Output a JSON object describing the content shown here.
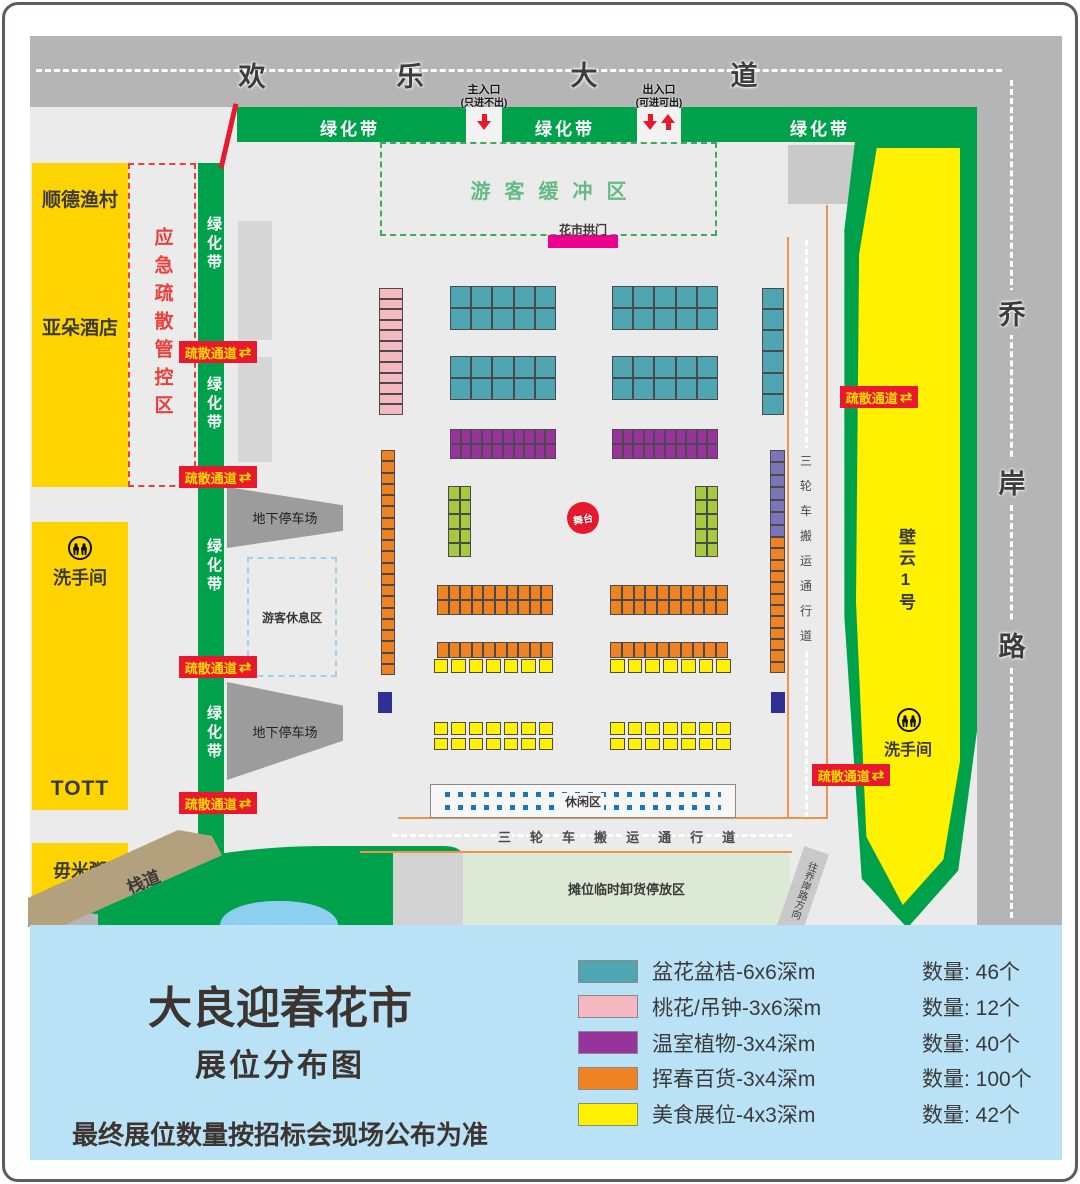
{
  "palette": {
    "road": "#b5b5b5",
    "ground": "#ebebeb",
    "green": "#00a14b",
    "buildingYellow": "#ffd400",
    "brightYellow": "#fff100",
    "teal": "#4fa6b2",
    "pink": "#f4b8c1",
    "purple": "#97339b",
    "orange": "#ef8222",
    "lime": "#a6c93f",
    "slate": "#7b74b9",
    "navy": "#2e3192",
    "magenta": "#ec008c",
    "red": "#e8192c",
    "brown": "#b3a17e",
    "paleGreen": "#dcead5",
    "legendBlue": "#b9e2f6",
    "pond": "#8ccfee",
    "grayBuilding": "#d6d6d6",
    "parkingGray": "#9c9c9c"
  },
  "roads": {
    "top_name": "欢乐大道",
    "right_name": "乔岸路"
  },
  "entrances": {
    "main": {
      "title": "主入口",
      "note": "(只进不出)"
    },
    "exit": {
      "title": "出入口",
      "note": "(可进可出)"
    }
  },
  "belts": {
    "label": "绿化带"
  },
  "badges": {
    "label": "疏散通道",
    "arrow": "⇄"
  },
  "zones": {
    "buffer": "游客缓冲区",
    "arch": "花市拱门",
    "emergency": "应急疏散管控区",
    "parking": "地下停车场",
    "rest": "游客休息区",
    "stage": "舞台",
    "leisure": "休闲区",
    "lane": "三轮车搬运通行道",
    "unload": "摊位临时卸货停放区",
    "walkway": "栈道",
    "direction": "往乔岸路方向",
    "biyun": "壁云1号",
    "restroom": "洗手间"
  },
  "buildings": {
    "b1a": "顺德渔村",
    "b1b": "亚朵酒店",
    "b2a": "洗手间",
    "b2b": "TOTT",
    "b3": "毋米粥"
  },
  "legend": {
    "title": "大良迎春花市",
    "subtitle": "展位分布图",
    "note": "最终展位数量按招标会现场公布为准",
    "items": [
      {
        "color": "#4fa6b2",
        "label": "盆花盆桔-6x6深m",
        "qty": "数量: 46个"
      },
      {
        "color": "#f4b8c1",
        "label": "桃花/吊钟-3x6深m",
        "qty": "数量: 12个"
      },
      {
        "color": "#97339b",
        "label": "温室植物-3x4深m",
        "qty": "数量: 40个"
      },
      {
        "color": "#ef8222",
        "label": "挥春百货-3x4深m",
        "qty": "数量: 100个"
      },
      {
        "color": "#fff100",
        "label": "美食展位-4x3深m",
        "qty": "数量: 42个"
      }
    ]
  }
}
